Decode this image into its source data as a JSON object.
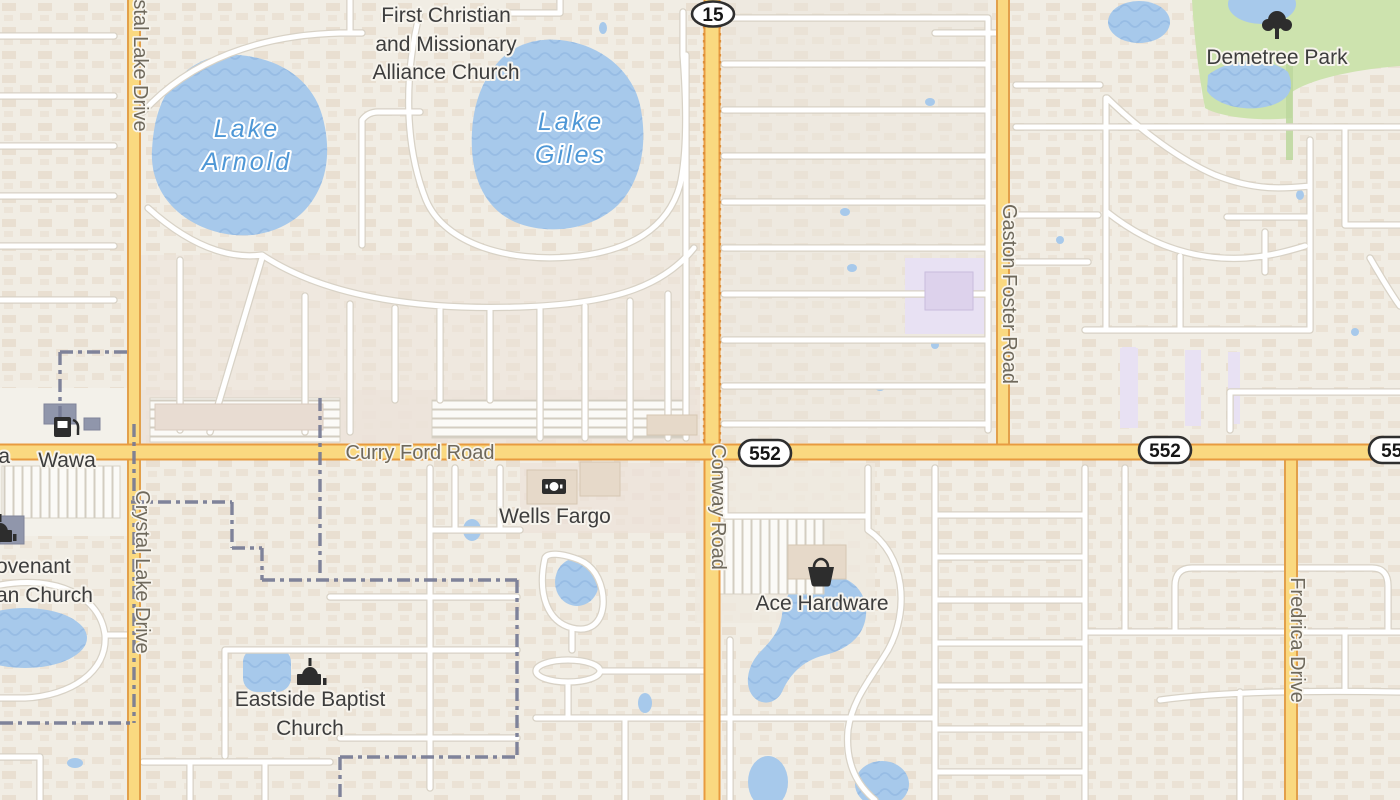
{
  "map": {
    "colors": {
      "background": "#f1ede4",
      "water": "#a7c9eb",
      "water_wave": "#8fb6e0",
      "park_green": "#cde3ae",
      "school_lavender": "#e8e1f3",
      "major_road_fill": "#fad980",
      "major_road_casing": "#e89b40",
      "boundary": "#757a94"
    },
    "shields": {
      "route15": "15",
      "route552": "552"
    },
    "roads": {
      "curry_ford": "Curry Ford Road",
      "conway": "Conway Road",
      "crystal_lake": "Crystal Lake Drive",
      "gaston_foster": "Gaston Foster Road",
      "fredrica": "Fredrica Drive",
      "west_edge_fragment": "a"
    },
    "lakes": {
      "arnold_line1": "Lake",
      "arnold_line2": "Arnold",
      "giles_line1": "Lake",
      "giles_line2": "Giles"
    },
    "pois": {
      "first_christian_line1": "First Christian",
      "first_christian_line2": "and Missionary",
      "first_christian_line3": "Alliance Church",
      "demetree_park": "Demetree Park",
      "wawa": "Wawa",
      "wells_fargo": "Wells Fargo",
      "ace_hardware": "Ace Hardware",
      "eastside_line1": "Eastside Baptist",
      "eastside_line2": "Church",
      "covenant_line1": "ovenant",
      "covenant_line2": "an Church"
    },
    "icons": {
      "gas": "gas-station-icon",
      "bank": "banknote-icon",
      "basket": "shopping-basket-icon",
      "church": "church-icon",
      "tree": "park-tree-icon"
    }
  }
}
